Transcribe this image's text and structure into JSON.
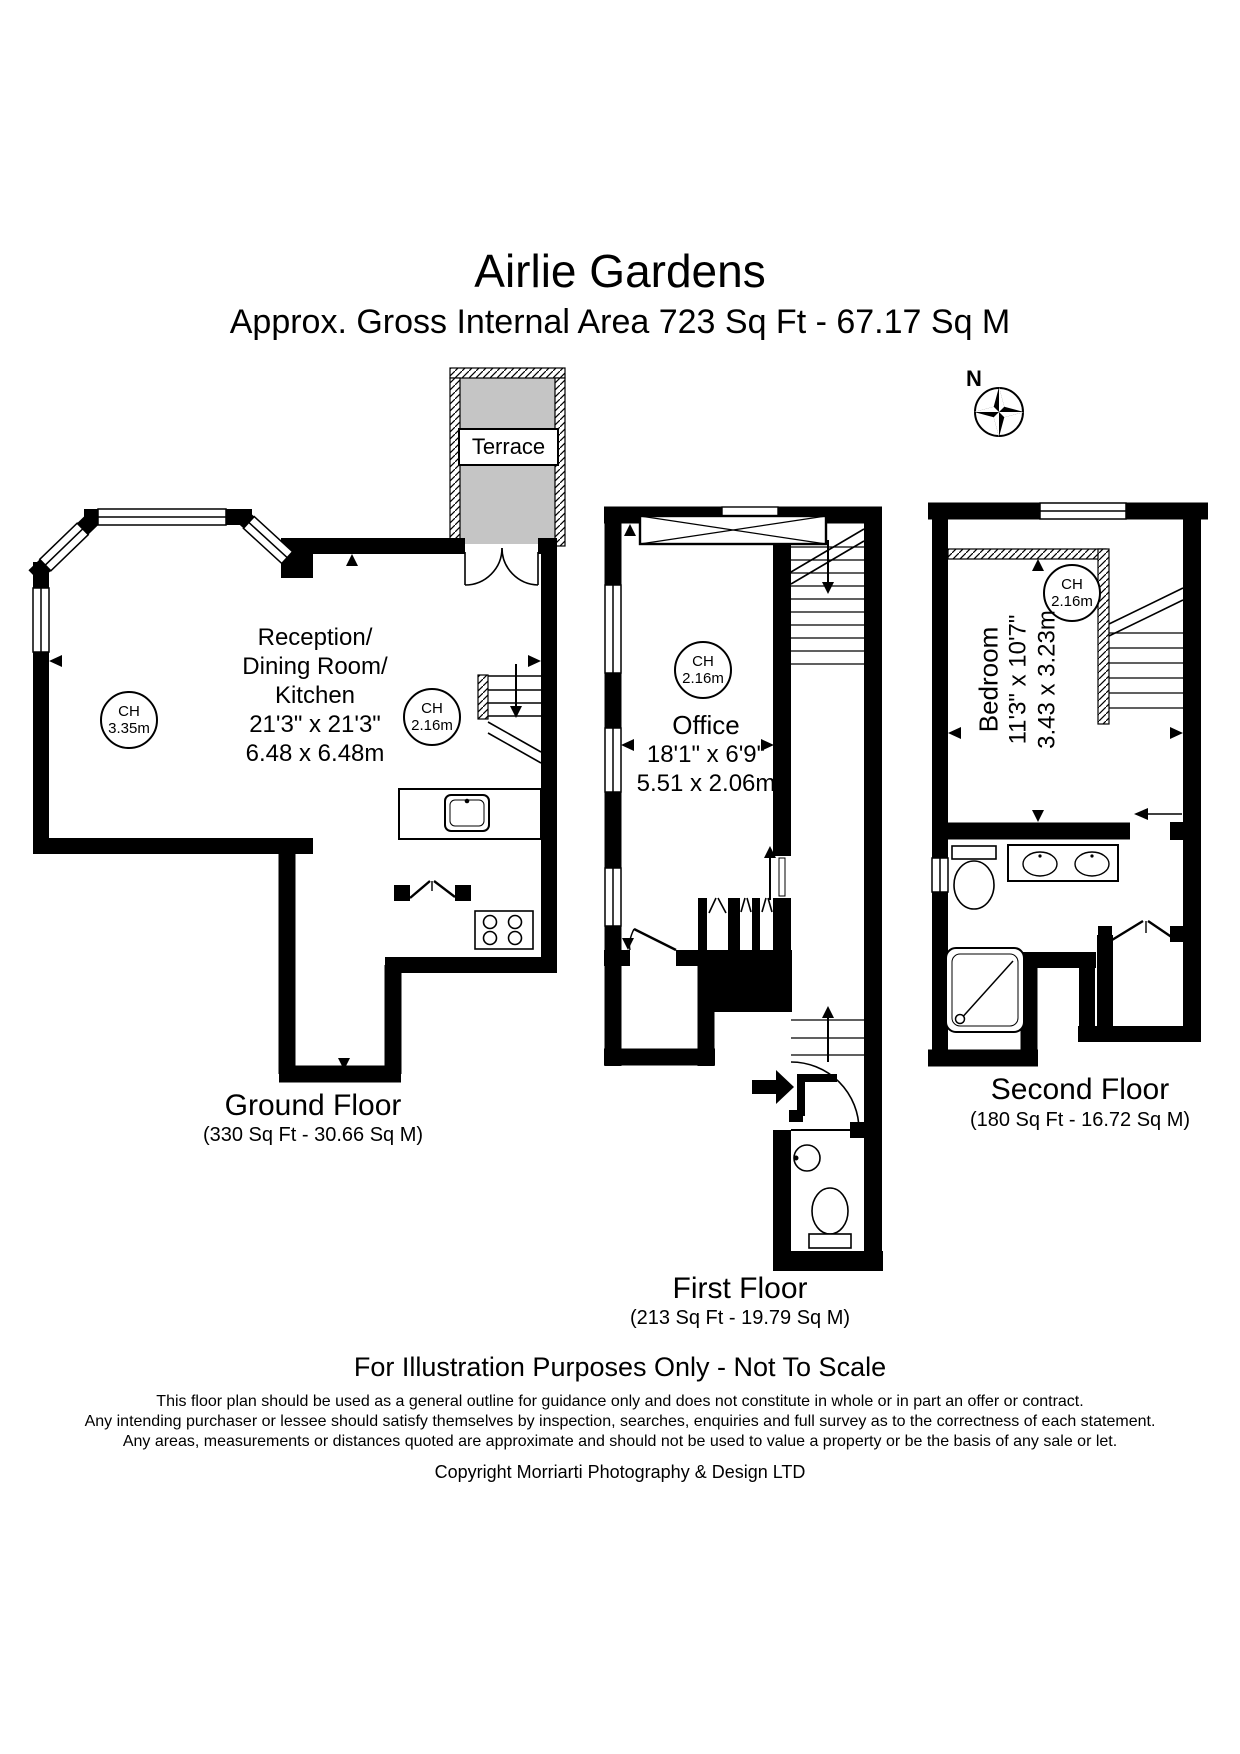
{
  "page": {
    "background": "#ffffff",
    "ink": "#000000",
    "terrace_fill": "#c5c5c5"
  },
  "header": {
    "title": "Airlie Gardens",
    "subtitle": "Approx. Gross Internal Area 723 Sq Ft  -  67.17 Sq M"
  },
  "compass": {
    "label": "N"
  },
  "floors": {
    "ground": {
      "label": "Ground Floor",
      "area": "(330 Sq Ft  -  30.66 Sq M)",
      "terrace_label": "Terrace",
      "room_lines": [
        "Reception/",
        "Dining Room/",
        "Kitchen",
        "21'3\" x 21'3\"",
        "6.48 x 6.48m"
      ],
      "ch_room": {
        "label": "CH",
        "value": "3.35m"
      },
      "ch_stairs": {
        "label": "CH",
        "value": "2.16m"
      }
    },
    "first": {
      "label": "First Floor",
      "area": "(213 Sq Ft  -  19.79 Sq M)",
      "room_lines": [
        "Office",
        "18'1\" x 6'9\"",
        "5.51 x 2.06m"
      ],
      "ch": {
        "label": "CH",
        "value": "2.16m"
      }
    },
    "second": {
      "label": "Second Floor",
      "area": "(180 Sq Ft  -  16.72 Sq M)",
      "room_lines": [
        "Bedroom",
        "11'3\" x 10'7\"",
        "3.43 x 3.23m"
      ],
      "ch": {
        "label": "CH",
        "value": "2.16m"
      }
    }
  },
  "footer": {
    "notice": "For Illustration Purposes Only - Not To Scale",
    "disclaimer_lines": [
      "This floor plan should be used as a general outline for guidance only and does not constitute in whole or in part an offer or contract.",
      "Any intending purchaser or lessee should satisfy themselves by inspection, searches, enquiries and full survey as to the correctness of each statement.",
      "Any areas, measurements or distances quoted are approximate and should not be used to value a property or be the basis of any sale or let."
    ],
    "copyright": "Copyright Morriarti Photography & Design LTD"
  }
}
